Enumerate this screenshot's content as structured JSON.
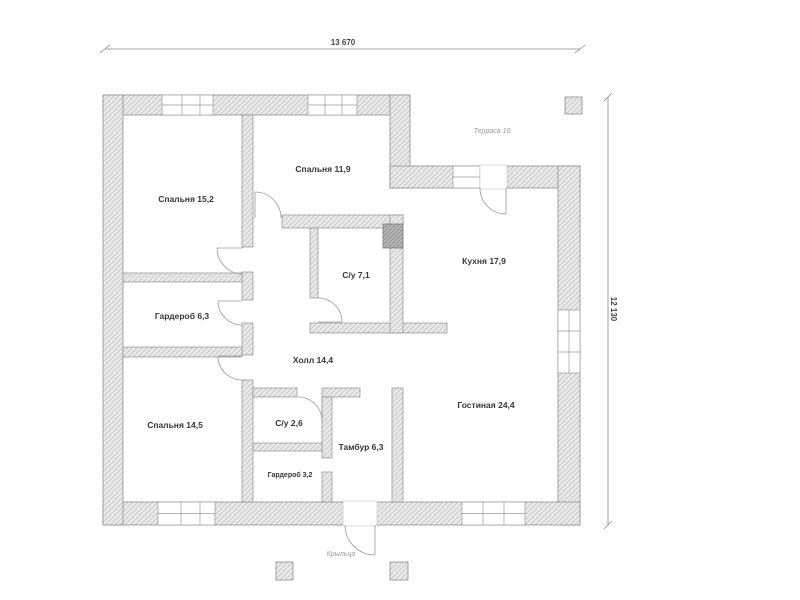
{
  "plan": {
    "dimensions": {
      "top": "13 670",
      "right": "12 130"
    },
    "rooms": [
      {
        "id": "bedroom-1",
        "label": "Спальня 15,2"
      },
      {
        "id": "bedroom-2",
        "label": "Спальня 11,9"
      },
      {
        "id": "bathroom-1",
        "label": "С/у 7,1"
      },
      {
        "id": "kitchen",
        "label": "Кухня 17,9"
      },
      {
        "id": "wardrobe-1",
        "label": "Гардероб 6,3"
      },
      {
        "id": "hall",
        "label": "Холл 14,4"
      },
      {
        "id": "bedroom-3",
        "label": "Спальня 14,5"
      },
      {
        "id": "bathroom-2",
        "label": "С/у 2,6"
      },
      {
        "id": "vestibule",
        "label": "Тамбур 6,3"
      },
      {
        "id": "wardrobe-2",
        "label": "Гардероб 3,2"
      },
      {
        "id": "living-room",
        "label": "Гостиная 24,4"
      }
    ],
    "outdoor": {
      "terrace": "Терраса 10",
      "porch": "Крыльцо"
    },
    "colors": {
      "wall_fill": "#eaeaea",
      "wall_hatch": "#c3c3c3",
      "wall_outline": "#8f8f8f",
      "vent_fill": "#b5b5b5",
      "room_text": "#35353d",
      "muted_text": "#9a9a9a"
    }
  }
}
